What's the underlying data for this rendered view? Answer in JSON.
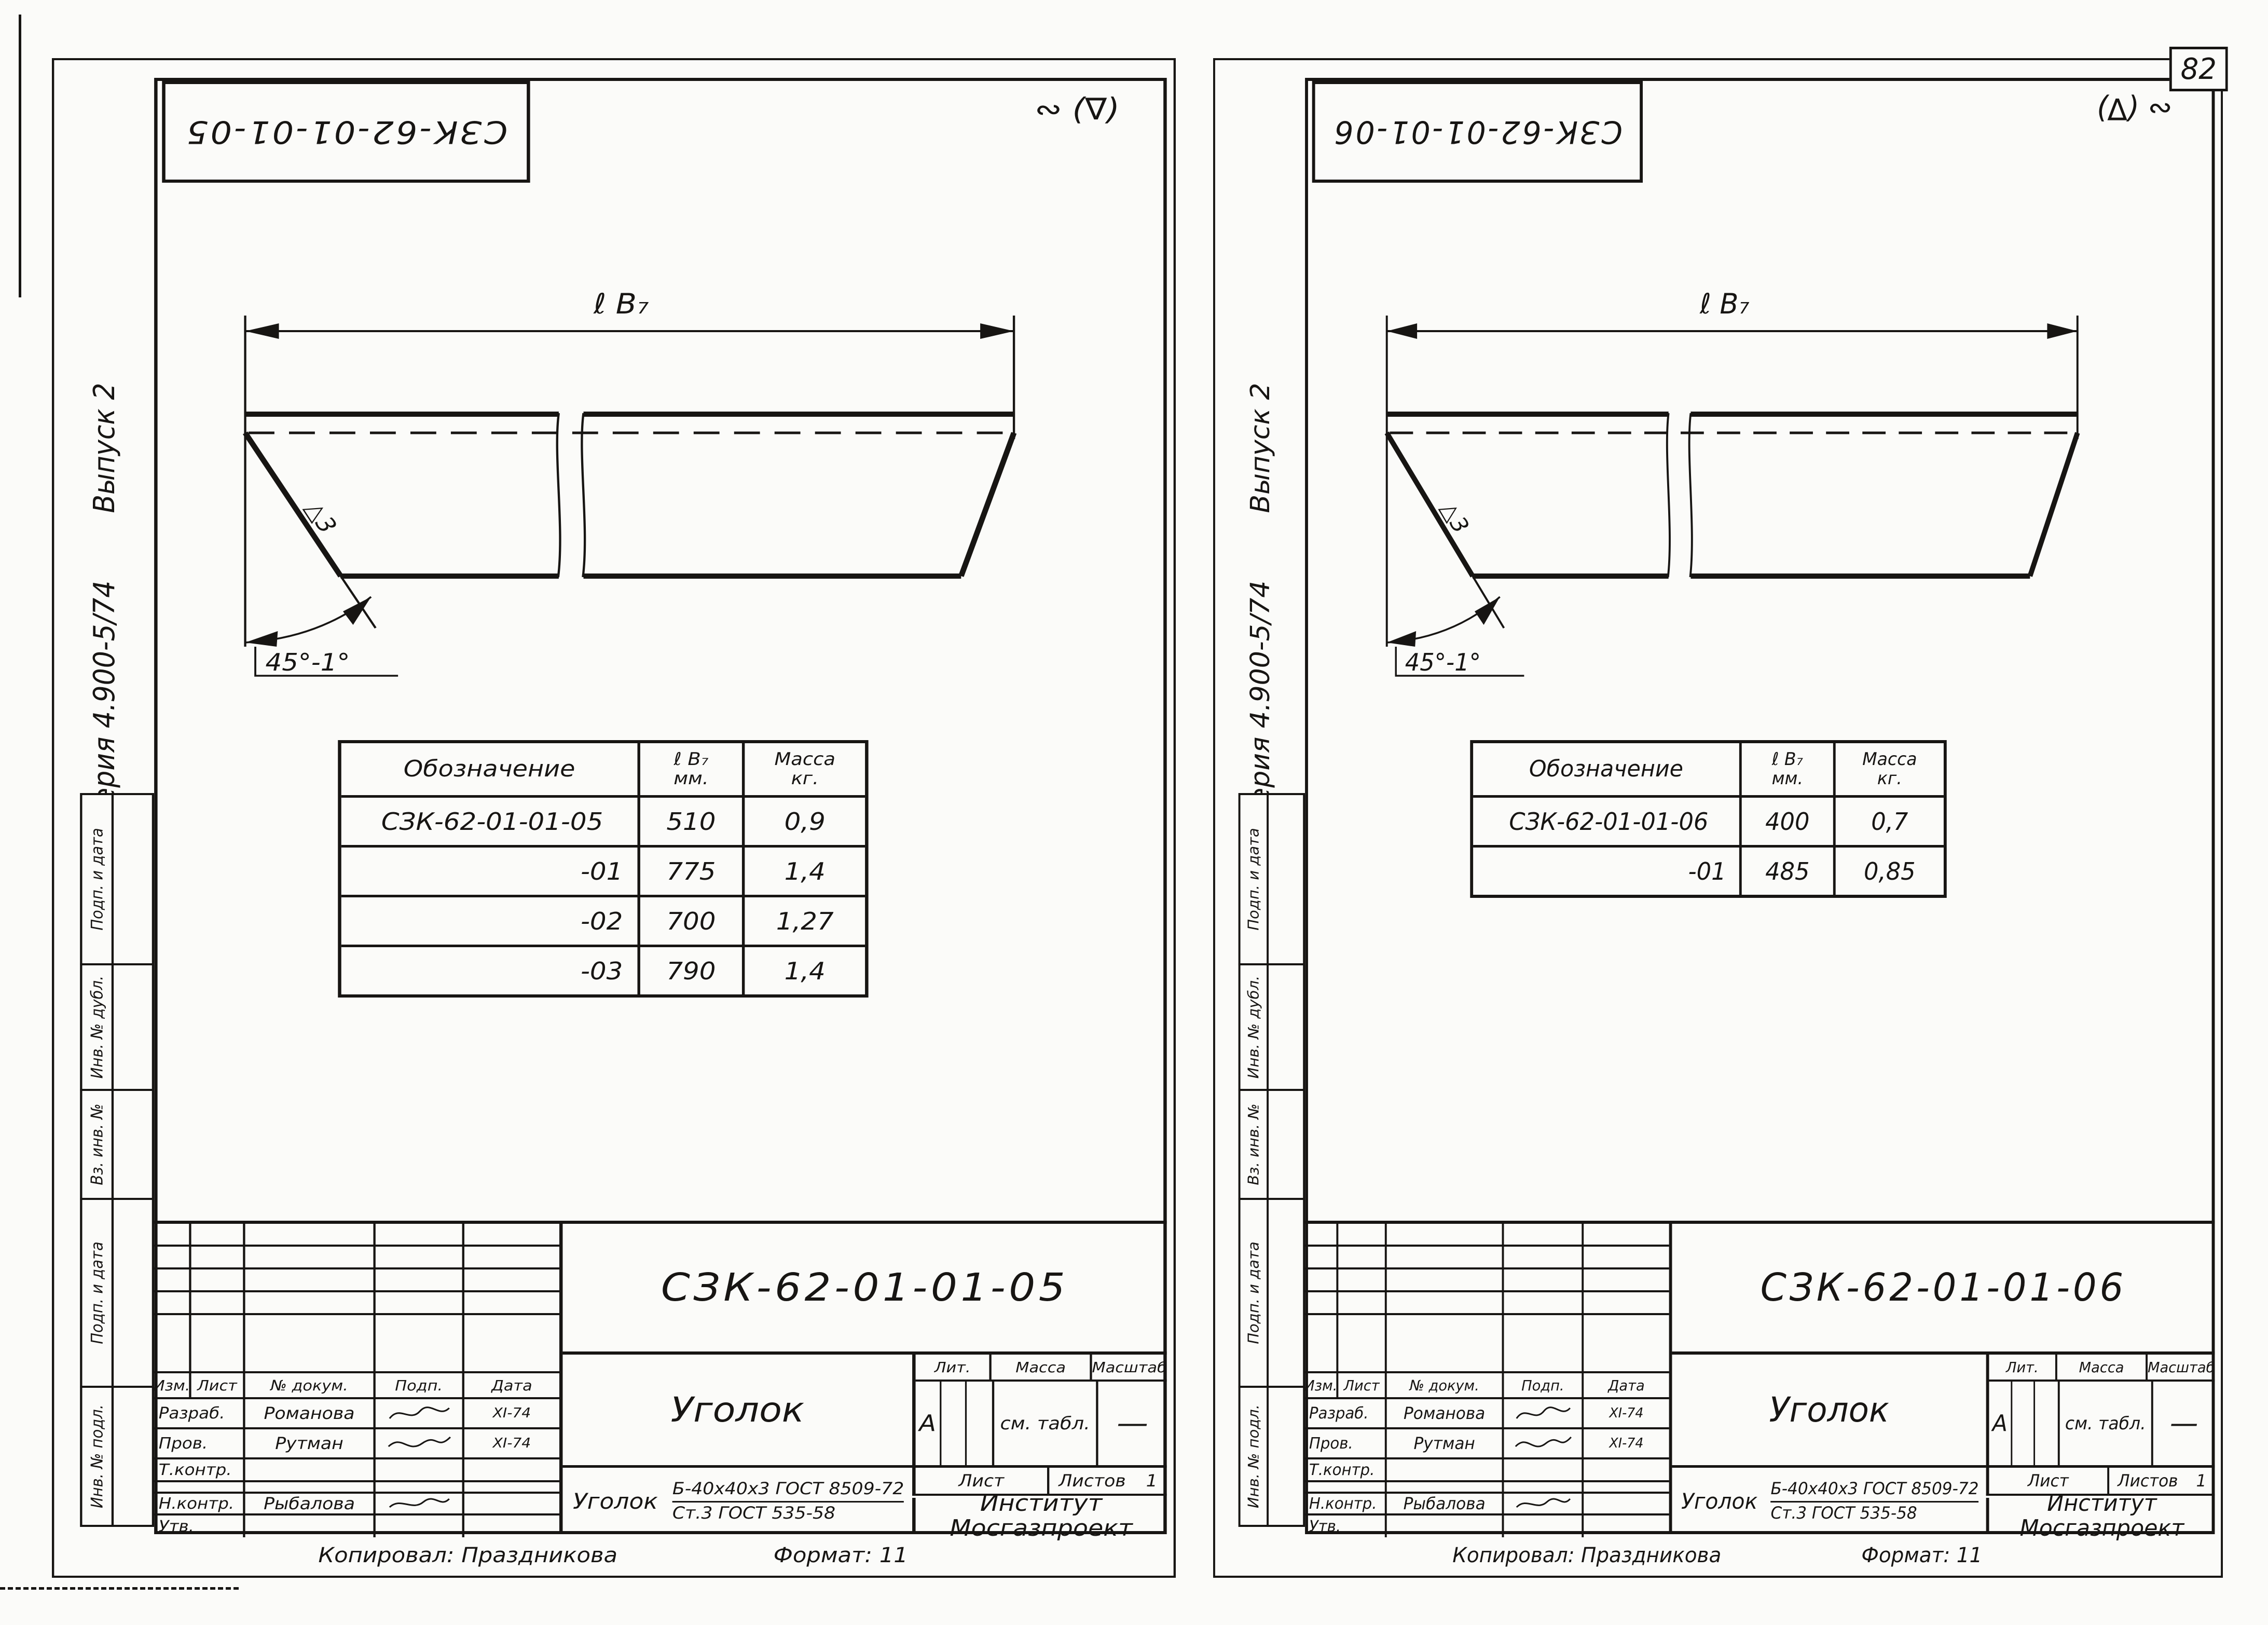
{
  "page": {
    "number": "82"
  },
  "sheets": [
    {
      "stamp": "СЗК-62-01-01-05",
      "mark": "∾ (∇)",
      "series": "Серия 4.900-5/74",
      "issue": "Выпуск 2",
      "margin_labels": [
        "Подп. и дата",
        "Инв. № дубл.",
        "Вз. инв. №",
        "Подп. и дата",
        "Инв. № подл."
      ],
      "drawing": {
        "dim": "ℓ B₇",
        "angle": "45°-1°",
        "weld": "△3"
      },
      "table": {
        "h_name": "Обозначение",
        "h_dim1": "ℓ B₇",
        "h_dim2": "мм.",
        "h_mass1": "Масса",
        "h_mass2": "кг.",
        "rows": [
          {
            "name": "СЗК-62-01-01-05",
            "len": "510",
            "mass": "0,9"
          },
          {
            "name": "-01",
            "len": "775",
            "mass": "1,4"
          },
          {
            "name": "-02",
            "len": "700",
            "mass": "1,27"
          },
          {
            "name": "-03",
            "len": "790",
            "mass": "1,4"
          }
        ]
      },
      "tb": {
        "doc": "СЗК-62-01-01-05",
        "part": "Уголок",
        "rev": {
          "izm": "Изм.",
          "list": "Лист",
          "doc": "№ докум.",
          "podp": "Подп.",
          "data": "Дата"
        },
        "rows": [
          {
            "role": "Разраб.",
            "name": "Романова",
            "date": "XI-74"
          },
          {
            "role": "Пров.",
            "name": "Рутман",
            "date": "XI-74"
          },
          {
            "role": "Т.контр.",
            "name": "",
            "date": ""
          },
          {
            "role": "Н.контр.",
            "name": "Рыбалова",
            "date": ""
          },
          {
            "role": "Утв.",
            "name": "",
            "date": ""
          }
        ],
        "lit_l": "Лит.",
        "mass_l": "Масса",
        "scale_l": "Масштаб",
        "lit": "А",
        "mass": "см. табл.",
        "scale": "—",
        "sheet_l": "Лист",
        "sheets_l": "Листов",
        "sheets_n": "1",
        "org1": "Институт",
        "org2": "Мосгазпроект",
        "mat_name": "Уголок",
        "mat1": "Б-40х40х3 ГОСТ 8509-72",
        "mat2": "Ст.3 ГОСТ 535-58"
      },
      "copied": "Копировал: Праздникова",
      "format": "Формат: 11"
    },
    {
      "stamp": "СЗК-62-01-01-06",
      "mark": "∾ (∇)",
      "series": "Серия 4.900-5/74",
      "issue": "Выпуск 2",
      "margin_labels": [
        "Подп. и дата",
        "Инв. № дубл.",
        "Вз. инв. №",
        "Подп. и дата",
        "Инв. № подл."
      ],
      "drawing": {
        "dim": "ℓ B₇",
        "angle": "45°-1°",
        "weld": "△3"
      },
      "table": {
        "h_name": "Обозначение",
        "h_dim1": "ℓ B₇",
        "h_dim2": "мм.",
        "h_mass1": "Масса",
        "h_mass2": "кг.",
        "rows": [
          {
            "name": "СЗК-62-01-01-06",
            "len": "400",
            "mass": "0,7"
          },
          {
            "name": "-01",
            "len": "485",
            "mass": "0,85"
          }
        ]
      },
      "tb": {
        "doc": "СЗК-62-01-01-06",
        "part": "Уголок",
        "rev": {
          "izm": "Изм.",
          "list": "Лист",
          "doc": "№ докум.",
          "podp": "Подп.",
          "data": "Дата"
        },
        "rows": [
          {
            "role": "Разраб.",
            "name": "Романова",
            "date": "XI-74"
          },
          {
            "role": "Пров.",
            "name": "Рутман",
            "date": "XI-74"
          },
          {
            "role": "Т.контр.",
            "name": "",
            "date": ""
          },
          {
            "role": "Н.контр.",
            "name": "Рыбалова",
            "date": ""
          },
          {
            "role": "Утв.",
            "name": "",
            "date": ""
          }
        ],
        "lit_l": "Лит.",
        "mass_l": "Масса",
        "scale_l": "Масштаб",
        "lit": "А",
        "mass": "см. табл.",
        "scale": "—",
        "sheet_l": "Лист",
        "sheets_l": "Листов",
        "sheets_n": "1",
        "org1": "Институт",
        "org2": "Мосгазпроект",
        "mat_name": "Уголок",
        "mat1": "Б-40х40х3 ГОСТ 8509-72",
        "mat2": "Ст.3 ГОСТ 535-58"
      },
      "copied": "Копировал: Праздникова",
      "format": "Формат: 11"
    }
  ]
}
